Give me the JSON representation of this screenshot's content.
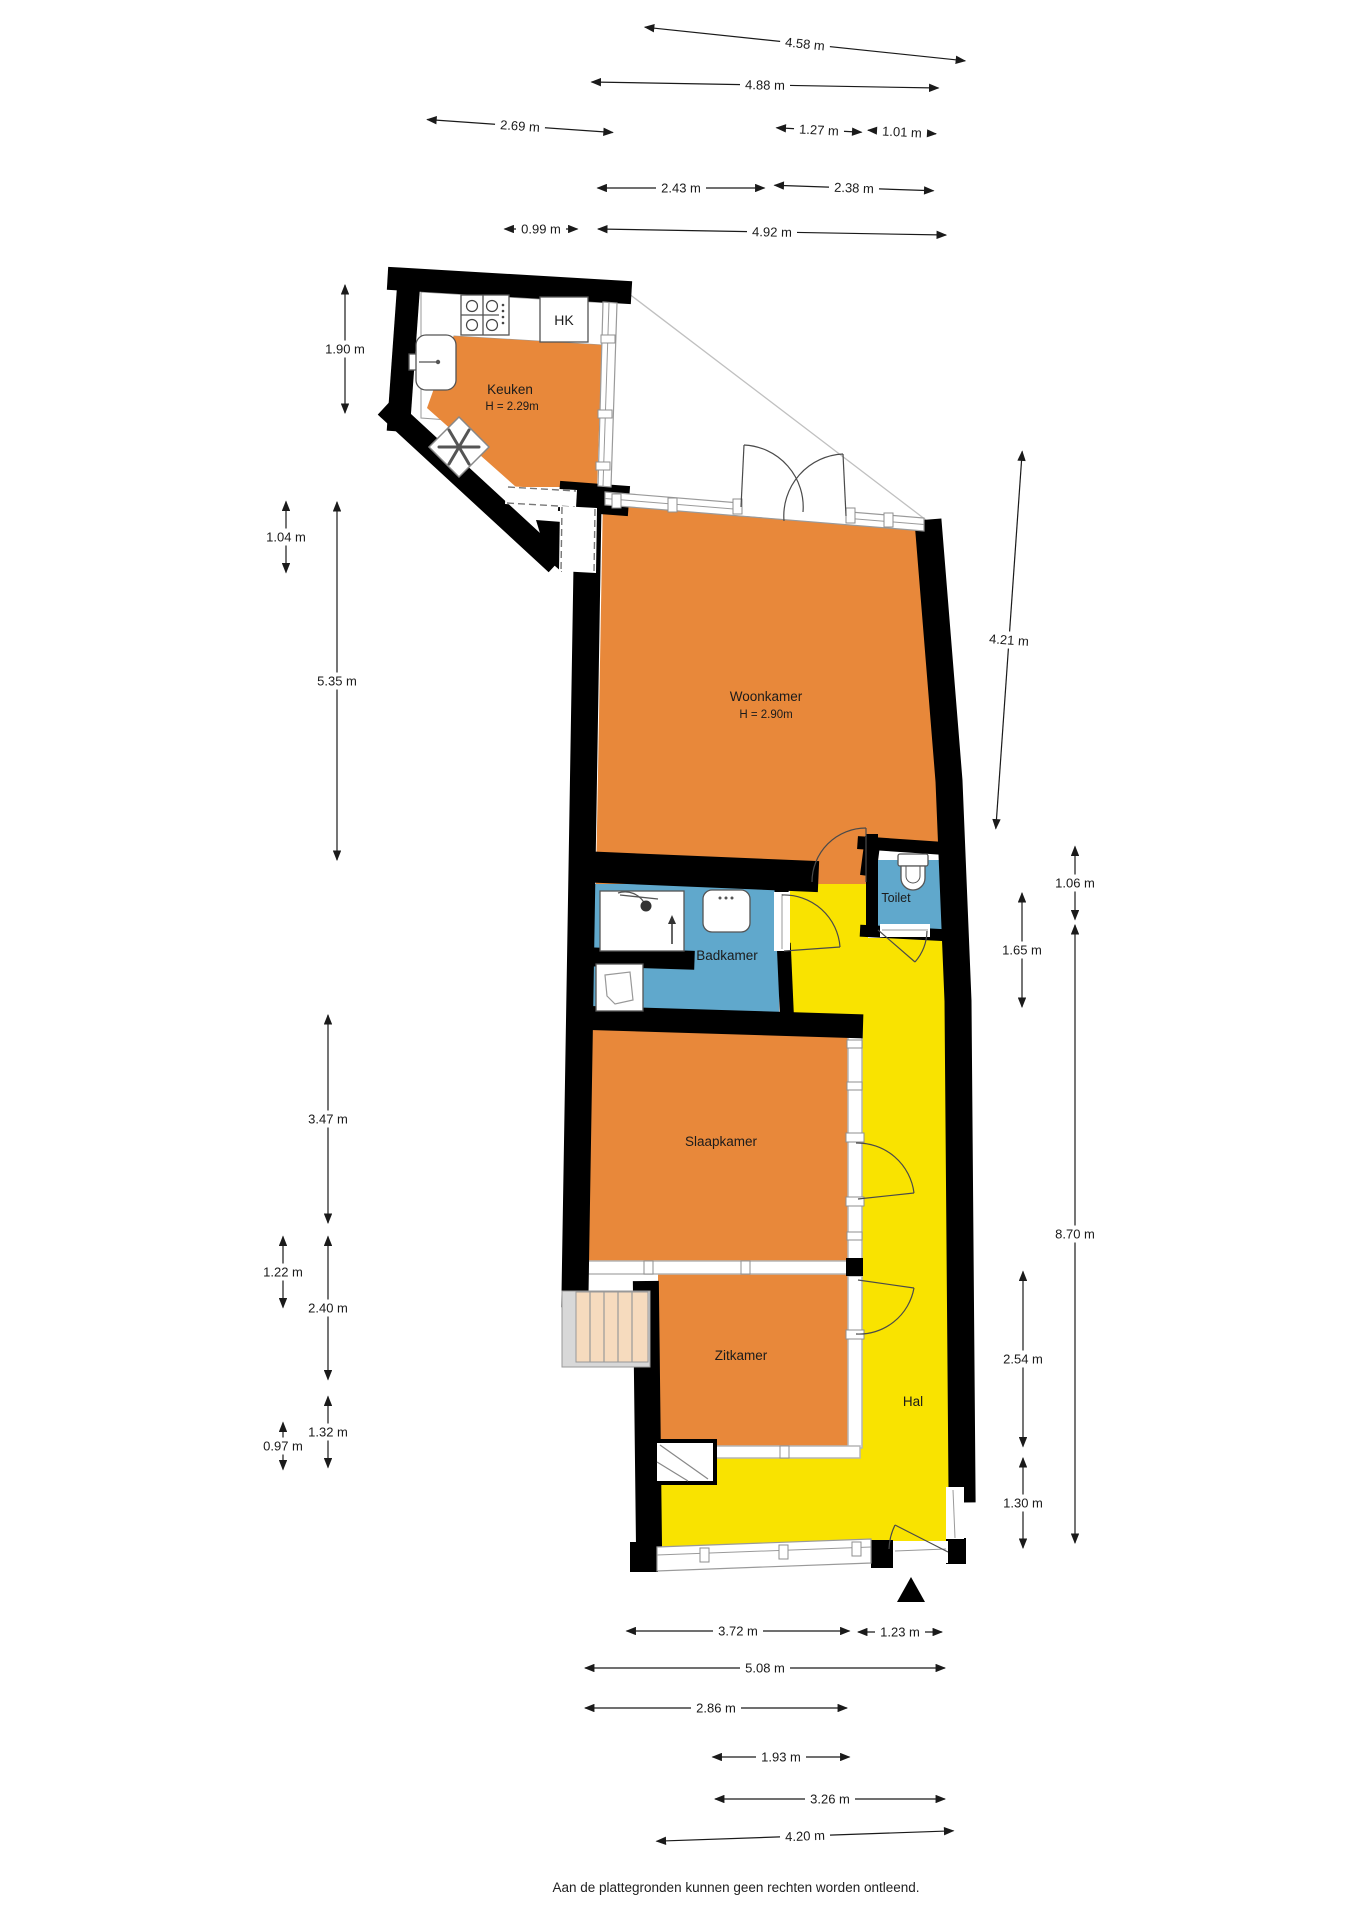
{
  "plan": {
    "rooms": {
      "keuken": {
        "label": "Keuken",
        "height": "H = 2.29m"
      },
      "woonkamer": {
        "label": "Woonkamer",
        "height": "H = 2.90m"
      },
      "badkamer": {
        "label": "Badkamer"
      },
      "toilet": {
        "label": "Toilet"
      },
      "slaapkamer": {
        "label": "Slaapkamer"
      },
      "zitkamer": {
        "label": "Zitkamer"
      },
      "hal": {
        "label": "Hal"
      },
      "hk": {
        "label": "HK"
      }
    },
    "colors": {
      "room_orange": "#E8883A",
      "hall_yellow": "#F9E300",
      "wet_blue": "#60A8CC",
      "stairs_peach": "#F6DBBE",
      "wall_black": "#000000"
    },
    "dimensions": {
      "top": [
        "4.58 m",
        "4.88 m",
        "2.69 m",
        "1.27 m",
        "1.01 m",
        "2.43 m",
        "2.38 m",
        "0.99 m",
        "4.92 m"
      ],
      "left": [
        "1.90 m",
        "1.04 m",
        "5.35 m",
        "3.47 m",
        "1.22 m",
        "2.40 m",
        "1.32 m",
        "0.97 m"
      ],
      "right": [
        "4.21 m",
        "1.06 m",
        "1.65 m",
        "8.70 m",
        "2.54 m",
        "1.30 m"
      ],
      "bottom": [
        "3.72 m",
        "1.23 m",
        "5.08 m",
        "2.86 m",
        "1.93 m",
        "3.26 m",
        "4.20 m"
      ]
    },
    "footer": "Aan de plattegronden kunnen geen rechten worden ontleend."
  }
}
